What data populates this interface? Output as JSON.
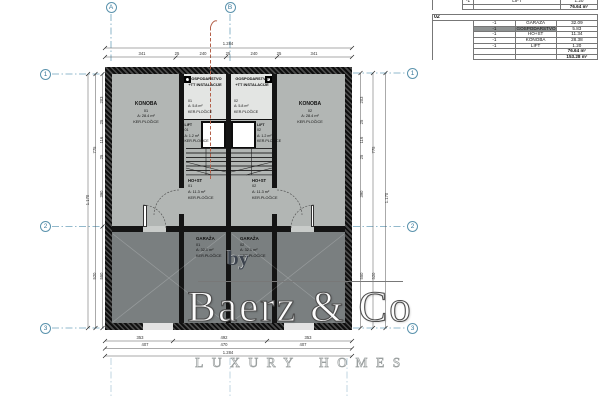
{
  "watermark": {
    "by": "by",
    "brand": "Baerz & Co",
    "tagline": "LUXURY HOMES"
  },
  "area_table": {
    "carry_row": {
      "qty": "-1",
      "name": "LIFT",
      "value": "1.20"
    },
    "carry_subtotal": "76.64 m²",
    "section_label": "02",
    "rows": [
      {
        "qty": "-1",
        "name": "GARAŽA",
        "value": "32.09"
      },
      {
        "qty": "-1",
        "name": "GOSPODARSTVO +TT INSTALACIJE",
        "value": "5.83",
        "highlight": true
      },
      {
        "qty": "-1",
        "name": "HO+ST",
        "value": "11.34"
      },
      {
        "qty": "-1",
        "name": "KONOBA",
        "value": "28.38"
      },
      {
        "qty": "-1",
        "name": "LIFT",
        "value": "1.20"
      }
    ],
    "subtotal": "76.64 m²",
    "total": "153.28 m²"
  },
  "grid_axes": {
    "top": [
      "A",
      "B"
    ],
    "left": [
      "1",
      "2",
      "3"
    ],
    "right": [
      "1",
      "2",
      "3"
    ]
  },
  "dimensions": {
    "top_total": "1.284",
    "top_segments": [
      "341",
      "25",
      "240",
      "25",
      "240",
      "25",
      "341"
    ],
    "bottom_segments_1": [
      "353",
      "492",
      "353"
    ],
    "bottom_segments_2": [
      "407",
      "470",
      "407"
    ],
    "bottom_total": "1.284",
    "side_segments": [
      "203",
      "25",
      "116",
      "25",
      "390",
      "550"
    ],
    "side_mid": [
      "775",
      "520"
    ],
    "side_total": "1.170"
  },
  "rooms": {
    "konoba_01": {
      "name": "KONOBA",
      "num": "01",
      "area": "A: 28.4 m²",
      "floor": "KER.PLOČICE"
    },
    "konoba_02": {
      "name": "KONOBA",
      "num": "02",
      "area": "A: 28.4 m²",
      "floor": "KER.PLOČICE"
    },
    "gospodarstvo_01": {
      "name": "GOSPODARSTVO",
      "name2": "+TT INSTALACIJE",
      "num": "01",
      "area": "A: 5.8 m²",
      "floor": "KER.PLOČICE"
    },
    "gospodarstvo_02": {
      "name": "GOSPODARSTVO",
      "name2": "+TT INSTALACIJE",
      "num": "02",
      "area": "A: 5.8 m²",
      "floor": "KER.PLOČICE"
    },
    "lift_01": {
      "name": "LIFT",
      "num": "01",
      "area": "A: 1.2 m²",
      "floor": "KER.PLOČICE"
    },
    "lift_02": {
      "name": "LIFT",
      "num": "02",
      "area": "A: 1.2 m²",
      "floor": "KER.PLOČICE"
    },
    "host_01": {
      "name": "HO+ST",
      "num": "01",
      "area": "A: 11.3 m²",
      "floor": "KER.PLOČICE"
    },
    "host_02": {
      "name": "HO+ST",
      "num": "02",
      "area": "A: 11.3 m²",
      "floor": "KER.PLOČICE"
    },
    "garaza_01": {
      "name": "GARAŽA",
      "num": "01",
      "area": "A: 32.1 m²",
      "floor": "KER.PLOČICE"
    },
    "garaza_02": {
      "name": "GARAŽA",
      "num": "02",
      "area": "A: 32.1 m²",
      "floor": "KER.PLOČICE"
    }
  }
}
